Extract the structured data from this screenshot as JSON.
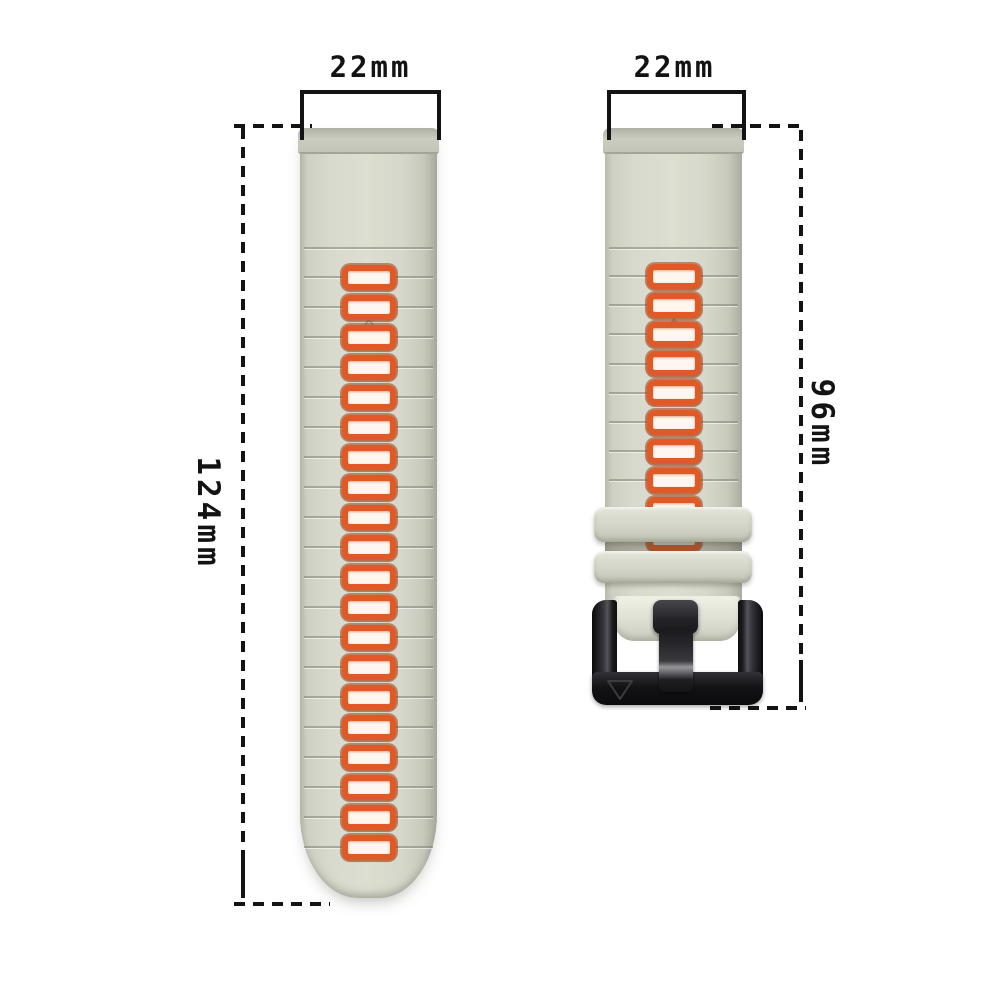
{
  "diagram": {
    "type": "product-dimension-diagram",
    "product": "two-piece silicone quick-release watch band",
    "background": "#ffffff"
  },
  "labels": {
    "left_strap_width": "22mm",
    "left_strap_length": "124mm",
    "right_strap_width": "22mm",
    "right_strap_length": "96mm"
  },
  "straps": {
    "left": {
      "name": "long-strap",
      "hole_count": 20,
      "marker_icon": "triangle-up-icon"
    },
    "right": {
      "name": "short-strap",
      "hole_count": 10,
      "keeper_count": 2,
      "has_buckle": true,
      "marker_icon": "triangle-up-icon",
      "buckle_engraving_icon": "triangle-down-icon"
    }
  },
  "colors": {
    "strap_body": "#d6d8cb",
    "strap_edge": "#a9ac9e",
    "hole_border": "#e05a28",
    "hole_fill": "#fdf7ef",
    "keeper": "#d4d6c9",
    "buckle": "#17171a",
    "dimension_ink": "#131313"
  }
}
